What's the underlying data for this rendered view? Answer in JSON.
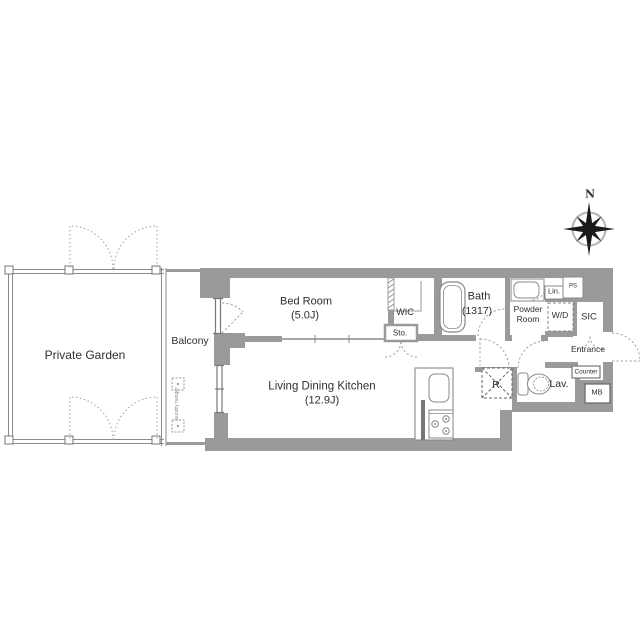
{
  "colors": {
    "wall": "#9a9a9a",
    "line": "#8a8a8a",
    "dash": "#9f9f9f",
    "text": "#2f2f2f"
  },
  "compass": {
    "north_label": "N"
  },
  "outdoor": {
    "private_garden": "Private Garden",
    "balcony": "Balcony",
    "laundry_hanger": "laundry hanger"
  },
  "rooms": {
    "bed_room": {
      "name": "Bed Room",
      "size": "(5.0J)"
    },
    "ldk": {
      "name": "Living Dining Kitchen",
      "size": "(12.9J)"
    },
    "bath": {
      "name": "Bath",
      "size": "(1317)"
    },
    "wic": "WIC",
    "storage": "Sto.",
    "powder_room_line1": "Powder",
    "powder_room_line2": "Room",
    "linen": "Lin.",
    "pipe_space": "PS",
    "washer_dryer": "W/D",
    "shoes_closet": "SIC",
    "entrance": "Entrance",
    "counter": "Counter",
    "lavatory": "Lav.",
    "refrigerator": "R",
    "meter_box": "MB"
  }
}
